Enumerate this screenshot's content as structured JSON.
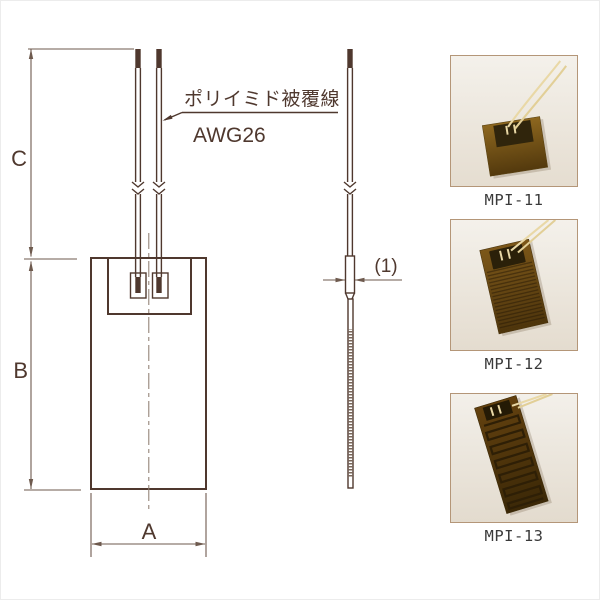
{
  "diagram": {
    "dimensions": {
      "width_label": "A",
      "length_label": "B",
      "lead_length_label": "C",
      "thickness_label": "(1)"
    },
    "callout": {
      "line1": "ポリイミド被覆線",
      "line2": "AWG26"
    },
    "colors": {
      "drawing_line": "#4f382e",
      "dimension_line": "#6e5a4e",
      "photo_border": "#b49678",
      "heater_film": "#7c5719",
      "label_text": "#3a3a3a"
    }
  },
  "products": [
    {
      "label": "MPI-11"
    },
    {
      "label": "MPI-12"
    },
    {
      "label": "MPI-13"
    }
  ]
}
